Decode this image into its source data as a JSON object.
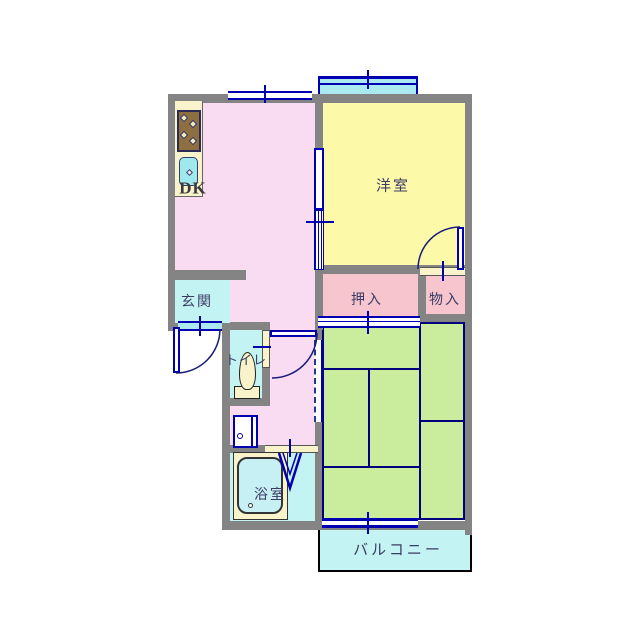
{
  "title": "apartment-floorplan",
  "rooms": {
    "dk": {
      "label": "DK"
    },
    "western_room": {
      "label": "洋室"
    },
    "entrance": {
      "label": "玄関"
    },
    "closet": {
      "label": "押入"
    },
    "storage": {
      "label": "物入"
    },
    "toilet": {
      "label": "トイレ"
    },
    "bathroom": {
      "label": "浴室"
    },
    "balcony": {
      "label": "バルコニー"
    }
  },
  "colors": {
    "wall": "#848484",
    "dk_and_hall": "#f9dbf2",
    "western_room": "#fcf9a8",
    "tatami_room": "#c9ed9d",
    "water_rooms": "#c3f3f2",
    "closet": "#f6c5ce",
    "fixture_cream": "#f8f3cb",
    "opening_blue": "#0000b0",
    "tatami_border": "#00007d",
    "balcony_border": "#000000",
    "stove_brown": "#8d6f42",
    "label_text": "#3c3c64"
  }
}
